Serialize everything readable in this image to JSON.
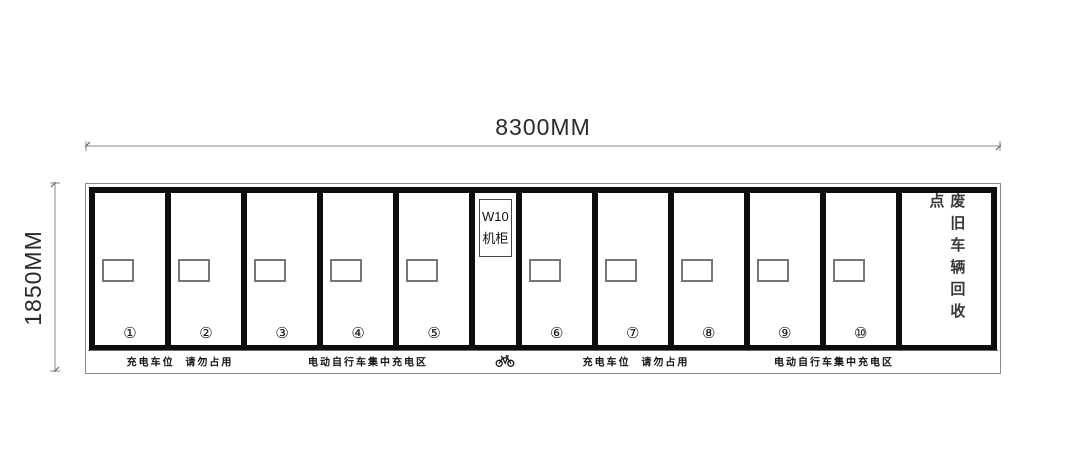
{
  "drawing": {
    "dimensions": {
      "width_label": "8300MM",
      "height_label": "1850MM"
    },
    "unit": {
      "cabinet": {
        "line1": "W10",
        "line2": "机柜"
      },
      "recycle_area_label": "废旧车辆回收点",
      "stalls": [
        {
          "number": "①"
        },
        {
          "number": "②"
        },
        {
          "number": "③"
        },
        {
          "number": "④"
        },
        {
          "number": "⑤"
        },
        {
          "number": "⑥"
        },
        {
          "number": "⑦"
        },
        {
          "number": "⑧"
        },
        {
          "number": "⑨"
        },
        {
          "number": "⑩"
        }
      ]
    },
    "base": {
      "labels": [
        "充电车位 请勿占用",
        "电动自行车集中充电区",
        "充电车位 请勿占用",
        "电动自行车集中充电区"
      ],
      "icon": "bicycle"
    },
    "colors": {
      "frame": "#0d0d0d",
      "dimension_line": "#8a8a8a",
      "text": "#222222"
    }
  }
}
